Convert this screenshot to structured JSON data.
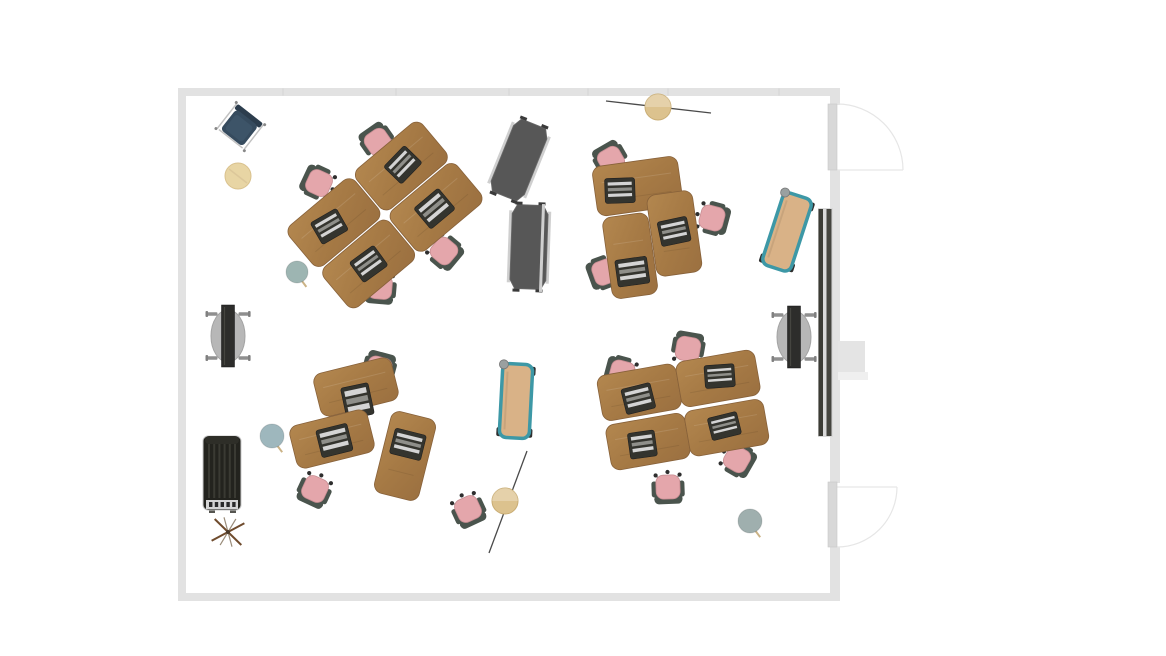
{
  "canvas": {
    "width": 1166,
    "height": 656,
    "background": "#ffffff"
  },
  "palette": {
    "wall": "#e2e2e2",
    "wall_tick": "#d4d4d4",
    "floor": "#ffffff",
    "door_leaf": "#d8d8d8",
    "door_leaf_edge": "#c9c9c9",
    "door_line": "#e6e6e6",
    "wood_light": "#b3874f",
    "wood_mid": "#a67a45",
    "wood_dark": "#9b7040",
    "desk_edge": "#87613a",
    "chair_seat": "#e4a6ab",
    "chair_seat_edge": "#c78d92",
    "chair_frame": "#4a544d",
    "caster": "#2e2e2e",
    "caster_arm": "#8a8a8a",
    "laptop_body": "#34342e",
    "laptop_edge": "#1f1f1f",
    "laptop_stripe_light": "#d4d4d4",
    "laptop_stripe_mid": "#8f8f8a",
    "divider_face": "#575757",
    "divider_face_edge": "#6a6a6a",
    "divider_edge": "#cfcfcf",
    "divider_foot": "#3a3a3a",
    "bench_frame": "#3d98a6",
    "bench_seat": "#d9b287",
    "bench_wheel": "#2f2f2f",
    "bench_knob": "#9aa0a0",
    "locker_body": "#23231e",
    "locker_cap": "#2e2e28",
    "locker_rib": "#3a3a33",
    "locker_grille": "#d5d5d5",
    "locker_dash": "#2a2a2a",
    "locker_outline": "#c9c9c9",
    "table_oval": "#b7b7b7",
    "table_oval_edge": "#a3a3a3",
    "table_bar": "#2d2d2b",
    "table_bar_edge": "#151515",
    "table_caster": "#8f8f8f",
    "pouf": "#e8d5a4",
    "pouf_edge": "#d9c18d",
    "pouf_seam": "#dcc79a",
    "lamp_shade": "#dcc28e",
    "lamp_shade_edge": "#c9ad74",
    "lamp_rod": "#4a4a4a",
    "lounge_seat": "#364b5e",
    "lounge_cushion": "#3d5468",
    "lounge_back": "#2c3d4d",
    "lounge_frame": "#c2c2c2",
    "coat_wood": "#6f4b2d",
    "coat_metal": "#9a8c7a",
    "coat_hub": "#4a3a2a",
    "media_backing": "#d9d9d9",
    "media_strip_a": "#3b3b35",
    "media_strip_b": "#44443e",
    "column": "#e4e4e4",
    "column_base": "#efefef",
    "stool_teal": "#9db5b2",
    "stool_blue": "#9eb7bd",
    "stool_gray": "#9fafae",
    "stool_leg": "#cbb386"
  },
  "room": {
    "floor": {
      "x": 186,
      "y": 96,
      "w": 644,
      "h": 497
    },
    "walls": [
      {
        "name": "wall-top",
        "x": 178,
        "y": 88,
        "w": 662,
        "h": 8
      },
      {
        "name": "wall-left",
        "x": 178,
        "y": 88,
        "w": 8,
        "h": 513
      },
      {
        "name": "wall-bottom",
        "x": 178,
        "y": 593,
        "w": 662,
        "h": 8
      },
      {
        "name": "wall-right-upper",
        "x": 830,
        "y": 88,
        "w": 10,
        "h": 17
      },
      {
        "name": "wall-right-middle",
        "x": 830,
        "y": 170,
        "w": 10,
        "h": 313
      },
      {
        "name": "wall-right-lower",
        "x": 830,
        "y": 547,
        "w": 10,
        "h": 54
      }
    ],
    "wall_ticks": [
      283,
      396,
      509,
      588,
      668,
      779
    ],
    "doors": [
      {
        "name": "door-north",
        "leaf": {
          "x": 828,
          "y": 104,
          "w": 9,
          "h": 66
        },
        "arc": "M 837 104 A 66 66 0 0 1 903 170",
        "line": {
          "x1": 837,
          "y1": 170,
          "x2": 903,
          "y2": 170
        }
      },
      {
        "name": "door-south",
        "leaf": {
          "x": 828,
          "y": 482,
          "w": 9,
          "h": 65
        },
        "arc": "M 897 487 A 60 60 0 0 1 837 547",
        "line": {
          "x1": 837,
          "y1": 487,
          "x2": 897,
          "y2": 487
        }
      }
    ],
    "column": {
      "name": "wall-column",
      "rects": [
        {
          "x": 838,
          "y": 341,
          "w": 27,
          "h": 31,
          "fill": "column"
        },
        {
          "x": 838,
          "y": 372,
          "w": 30,
          "h": 8,
          "fill": "column_base"
        }
      ]
    }
  },
  "furniture": [
    {
      "type": "media_wall",
      "name": "media-wall",
      "x": 818,
      "y": 208,
      "w": 15,
      "h": 229
    },
    {
      "type": "folded_table",
      "name": "flip-table-west",
      "x": 228,
      "y": 336,
      "rot": 0
    },
    {
      "type": "folded_table",
      "name": "flip-table-east",
      "x": 794,
      "y": 337,
      "rot": 0
    },
    {
      "type": "locker",
      "name": "storage-locker",
      "x": 222,
      "y": 474,
      "rot": 0
    },
    {
      "type": "coat_stand",
      "name": "coat-stand",
      "x": 228,
      "y": 532,
      "rot": 8
    },
    {
      "type": "divider",
      "name": "divider-panel-north",
      "x": 519,
      "y": 160,
      "rot": 22,
      "w": 36,
      "h": 78
    },
    {
      "type": "divider",
      "name": "divider-panel-south",
      "x": 529,
      "y": 247,
      "rot": 2,
      "w": 36,
      "h": 84
    },
    {
      "type": "rail",
      "name": "divider-rail",
      "x": 542,
      "y": 248,
      "rot": 2,
      "h": 88
    },
    {
      "type": "bench",
      "name": "whiteboard-cart-east",
      "x": 787,
      "y": 232,
      "rot": 18,
      "w": 30,
      "h": 76
    },
    {
      "type": "bench",
      "name": "whiteboard-cart-center",
      "x": 516,
      "y": 401,
      "rot": 3,
      "w": 30,
      "h": 74
    },
    {
      "type": "pouf",
      "name": "pouf",
      "x": 238,
      "y": 176,
      "r": 13
    },
    {
      "type": "stool",
      "name": "stool-northwest",
      "x": 297,
      "y": 272,
      "r": 11,
      "color": "stool_teal"
    },
    {
      "type": "stool",
      "name": "stool-west",
      "x": 272,
      "y": 436,
      "r": 12,
      "color": "stool_blue"
    },
    {
      "type": "stool",
      "name": "stool-southeast",
      "x": 750,
      "y": 521,
      "r": 12,
      "color": "stool_gray"
    },
    {
      "type": "chair",
      "name": "task-chair-nw-1",
      "x": 378,
      "y": 142,
      "rot": -35
    },
    {
      "type": "chair",
      "name": "task-chair-nw-2",
      "x": 319,
      "y": 183,
      "rot": -65
    },
    {
      "type": "chair",
      "name": "task-chair-nw-3",
      "x": 444,
      "y": 251,
      "rot": 130
    },
    {
      "type": "chair",
      "name": "task-chair-nw-4",
      "x": 380,
      "y": 287,
      "rot": 185
    },
    {
      "type": "chair",
      "name": "task-chair-ne-1",
      "x": 611,
      "y": 160,
      "rot": -30
    },
    {
      "type": "chair",
      "name": "task-chair-ne-2",
      "x": 712,
      "y": 218,
      "rot": 105
    },
    {
      "type": "chair",
      "name": "task-chair-ne-3",
      "x": 605,
      "y": 272,
      "rot": -110
    },
    {
      "type": "chair",
      "name": "task-chair-sw-1",
      "x": 379,
      "y": 369,
      "rot": 15
    },
    {
      "type": "chair",
      "name": "task-chair-sw-2",
      "x": 315,
      "y": 489,
      "rot": -155
    },
    {
      "type": "chair",
      "name": "task-chair-south-center",
      "x": 468,
      "y": 509,
      "rot": 155
    },
    {
      "type": "chair",
      "name": "task-chair-se-1",
      "x": 688,
      "y": 349,
      "rot": 10
    },
    {
      "type": "chair",
      "name": "task-chair-se-2",
      "x": 622,
      "y": 373,
      "rot": -75
    },
    {
      "type": "chair",
      "name": "task-chair-se-3",
      "x": 737,
      "y": 459,
      "rot": 120
    },
    {
      "type": "chair",
      "name": "task-chair-se-4",
      "x": 668,
      "y": 487,
      "rot": 178
    },
    {
      "type": "desk_cluster",
      "name": "desk-cluster-northwest",
      "x": 385,
      "y": 215,
      "rot": -40,
      "desks": [
        {
          "dx": -44,
          "dy": -27,
          "rot": 0,
          "w": 86,
          "h": 52,
          "laptop": {
            "dx": -6,
            "dy": 0,
            "rot": 10,
            "w": 30,
            "h": 25
          }
        },
        {
          "dx": 44,
          "dy": -27,
          "rot": 0,
          "w": 86,
          "h": 52,
          "laptop": {
            "dx": 2,
            "dy": 0,
            "rot": -6,
            "w": 30,
            "h": 25
          }
        },
        {
          "dx": -44,
          "dy": 27,
          "rot": 0,
          "w": 86,
          "h": 52,
          "laptop": {
            "dx": 0,
            "dy": 0,
            "rot": 4,
            "w": 30,
            "h": 25
          }
        },
        {
          "dx": 44,
          "dy": 27,
          "rot": 0,
          "w": 86,
          "h": 52,
          "laptop": {
            "dx": -2,
            "dy": 0,
            "rot": 0,
            "w": 32,
            "h": 27
          }
        }
      ]
    },
    {
      "type": "desk_cluster",
      "name": "desk-cluster-northeast",
      "x": 648,
      "y": 225,
      "rot": -8,
      "desks": [
        {
          "dx": -5,
          "dy": -40,
          "rot": 0,
          "w": 86,
          "h": 50,
          "laptop": {
            "dx": -18,
            "dy": 2,
            "rot": 6,
            "w": 30,
            "h": 25
          }
        },
        {
          "dx": -22,
          "dy": 28,
          "rot": 0,
          "w": 46,
          "h": 82,
          "laptop": {
            "dx": 0,
            "dy": 16,
            "rot": 0,
            "w": 32,
            "h": 27
          }
        },
        {
          "dx": 25,
          "dy": 12,
          "rot": 0,
          "w": 46,
          "h": 82,
          "laptop": {
            "dx": 0,
            "dy": -2,
            "rot": -4,
            "w": 30,
            "h": 25
          }
        }
      ]
    },
    {
      "type": "desk_cluster",
      "name": "desk-cluster-southwest",
      "x": 360,
      "y": 425,
      "rot": 0,
      "desks": [
        {
          "dx": -4,
          "dy": -38,
          "rot": -14,
          "w": 80,
          "h": 44,
          "laptop": {
            "dx": -2,
            "dy": 14,
            "rot": 2,
            "w": 28,
            "h": 32
          }
        },
        {
          "dx": -28,
          "dy": 14,
          "rot": -14,
          "w": 80,
          "h": 44,
          "laptop": {
            "dx": 2,
            "dy": 2,
            "rot": 0,
            "w": 32,
            "h": 28
          }
        },
        {
          "dx": 45,
          "dy": 31,
          "rot": 14,
          "w": 46,
          "h": 84,
          "laptop": {
            "dx": 0,
            "dy": -12,
            "rot": 0,
            "w": 32,
            "h": 26
          }
        }
      ]
    },
    {
      "type": "desk_cluster",
      "name": "desk-cluster-southeast",
      "x": 683,
      "y": 410,
      "rot": -10,
      "desks": [
        {
          "dx": -40,
          "dy": -25,
          "rot": 0,
          "w": 80,
          "h": 46,
          "laptop": {
            "dx": -2,
            "dy": 6,
            "rot": -4,
            "w": 30,
            "h": 26
          }
        },
        {
          "dx": 40,
          "dy": -25,
          "rot": 0,
          "w": 80,
          "h": 46,
          "laptop": {
            "dx": 2,
            "dy": -2,
            "rot": 6,
            "w": 30,
            "h": 23
          }
        },
        {
          "dx": -40,
          "dy": 25,
          "rot": 0,
          "w": 80,
          "h": 46,
          "laptop": {
            "dx": -6,
            "dy": 2,
            "rot": 2,
            "w": 27,
            "h": 26
          }
        },
        {
          "dx": 40,
          "dy": 25,
          "rot": 0,
          "w": 80,
          "h": 46,
          "laptop": {
            "dx": -2,
            "dy": -2,
            "rot": -4,
            "w": 30,
            "h": 23
          }
        }
      ]
    },
    {
      "type": "lounge_chair",
      "name": "lounge-chair",
      "x": 240,
      "y": 127,
      "rot": 38
    },
    {
      "type": "floor_lamp",
      "name": "floor-lamp-north",
      "shade": {
        "x": 658,
        "y": 107,
        "r": 13
      },
      "rod": {
        "x1": 606,
        "y1": 101,
        "x2": 711,
        "y2": 113
      }
    },
    {
      "type": "floor_lamp",
      "name": "floor-lamp-south",
      "shade": {
        "x": 505,
        "y": 501,
        "r": 13
      },
      "rod": {
        "x1": 527,
        "y1": 451,
        "x2": 489,
        "y2": 553
      }
    }
  ]
}
